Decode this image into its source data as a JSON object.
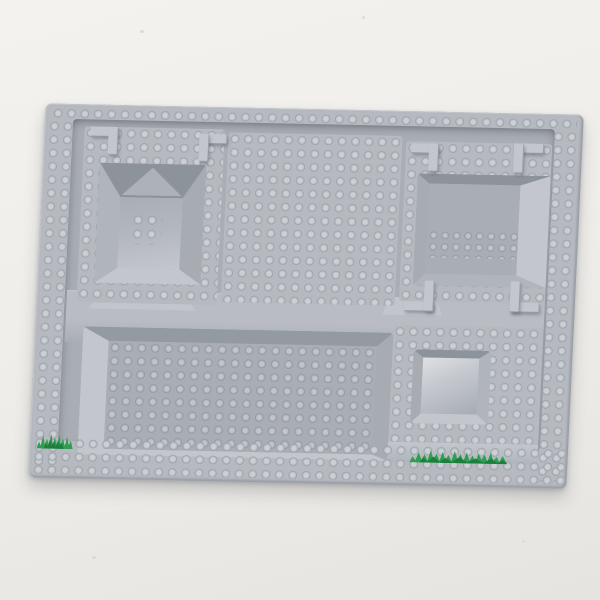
{
  "scene": {
    "type": "product photograph",
    "subject": "Light gray LEGO 3D molded raised baseplate photographed on a plain off-white surface",
    "visible_text": "none"
  },
  "colors": {
    "bg": "#efede9",
    "bg-lower": "#e6e4e0",
    "speck": "#dcdad6",
    "plate-base": "#b6bac0",
    "plate-edge": "#989ea6",
    "recess": "#a9aeb5",
    "band": "#b9bdc3",
    "s-hi": "#ccd0d5",
    "s-mid": "#bbbfc5",
    "s-edge": "#979da5",
    "stud-hi-dim": "#c2c6cc",
    "stud-mid-dim": "#aeb3b9",
    "stud-edge-dim": "#8f959d",
    "wall-shadow": "#939aa2",
    "wall-mid": "#a7acb3",
    "wall-mid2": "#b0b5bc",
    "wall-light": "#c3c7cd",
    "pit-far": "#8d939b",
    "pit-floor": "#b2b7bd",
    "gloss": "#dfe1e3",
    "grass": "#2f9e50",
    "grass-dark": "#1c7f3d",
    "shadow": "rgba(96,100,106,0.30)"
  },
  "plate": {
    "color_name": "light gray",
    "orientation": "slightly rotated clockwise, photographed from above",
    "features": {
      "rim": "studded border: 1 row on top edge, 2 columns on left and right edges, 2-3 rows on bottom edge",
      "top_left": "raised platform with deep beveled square pit; 2 x 2 studs on pit floor",
      "top_middle": "raised square platform fully covered in studs, approx 13 x 13",
      "top_right": "raised platform with rectangular recess; 2 rows of approx 9 studs on recess floor; ramp on right end",
      "middle": "smooth raised band crossing full width",
      "bottom_left": "large recessed stud field, approx 20 x 8, ramp on left side",
      "bottom_right": "raised studded platform with small smooth glossy square pit",
      "corner_brackets": "6 molded L-shaped corner wall pieces",
      "grass_prints": [
        "small green grass tuft at base of bottom-left ramp",
        "long green grass strip on slope below bottom-right platform"
      ]
    }
  }
}
